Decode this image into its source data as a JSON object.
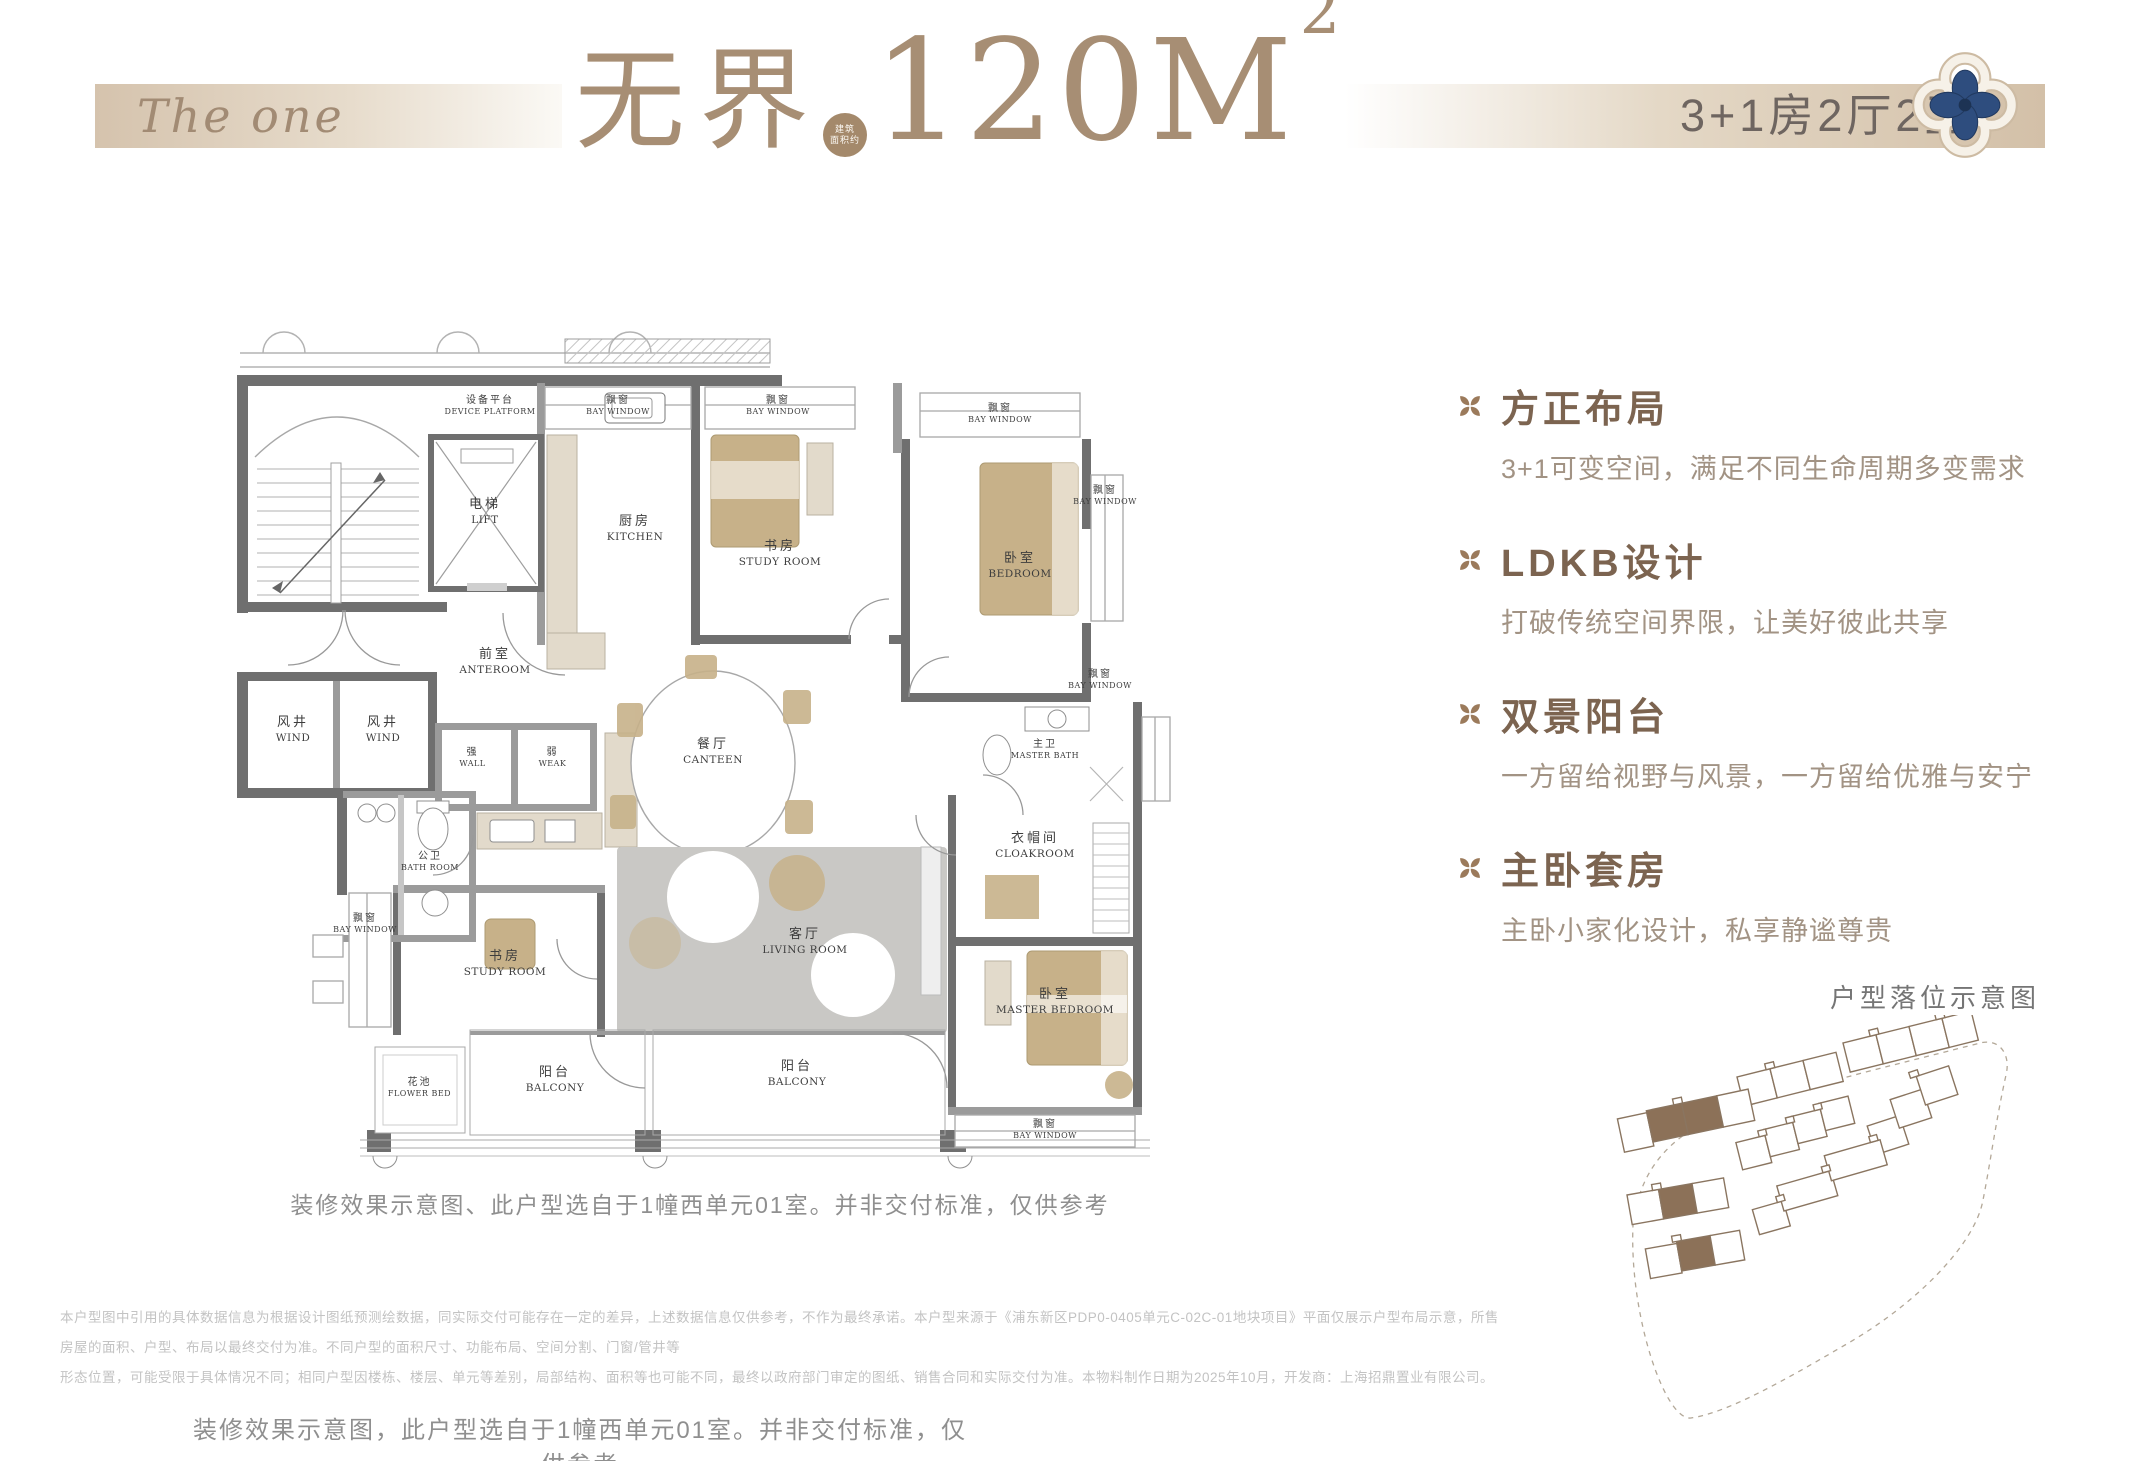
{
  "header": {
    "logo": "The one",
    "title_cn": "无界",
    "area_badge_line1": "建筑",
    "area_badge_line2": "面积约",
    "area_value": "120M",
    "area_sup": "2",
    "spec": "3+1房2厅2卫"
  },
  "floor_plan": {
    "rooms": {
      "device_platform": {
        "cn": "设备平台",
        "en": "DEVICE PLATFORM"
      },
      "lift": {
        "cn": "电梯",
        "en": "LIFT"
      },
      "kitchen": {
        "cn": "厨房",
        "en": "KITCHEN"
      },
      "study": {
        "cn": "书房",
        "en": "STUDY ROOM"
      },
      "bedroom": {
        "cn": "卧室",
        "en": "BEDROOM"
      },
      "wind": {
        "cn": "风井",
        "en": "WIND"
      },
      "anteroom": {
        "cn": "前室",
        "en": "ANTEROOM"
      },
      "strong": {
        "cn": "强",
        "en": "WALL"
      },
      "weak": {
        "cn": "弱",
        "en": "WEAK"
      },
      "canteen": {
        "cn": "餐厅",
        "en": "CANTEEN"
      },
      "bath": {
        "cn": "公卫",
        "en": "BATH ROOM"
      },
      "master_bath": {
        "cn": "主卫",
        "en": "MASTER BATH"
      },
      "cloakroom": {
        "cn": "衣帽间",
        "en": "CLOAKROOM"
      },
      "living": {
        "cn": "客厅",
        "en": "LIVING ROOM"
      },
      "flower_bed": {
        "cn": "花池",
        "en": "FLOWER BED"
      },
      "balcony": {
        "cn": "阳台",
        "en": "BALCONY"
      },
      "master_bedroom": {
        "cn": "卧室",
        "en": "MASTER BEDROOM"
      },
      "bay_window": {
        "cn": "飘窗",
        "en": "BAY WINDOW"
      }
    },
    "caption": "装修效果示意图、此户型选自于1幢西单元01室。并非交付标准，仅供参考"
  },
  "features": [
    {
      "title": "方正布局",
      "desc": "3+1可变空间，满足不同生命周期多变需求"
    },
    {
      "title": "LDKB设计",
      "desc": "打破传统空间界限，让美好彼此共享"
    },
    {
      "title": "双景阳台",
      "desc": "一方留给视野与风景，一方留给优雅与安宁"
    },
    {
      "title": "主卧套房",
      "desc": "主卧小家化设计，私享静谧尊贵"
    }
  ],
  "site_plan": {
    "label": "户型落位示意图"
  },
  "footer": {
    "disclaimer_line1": "本户型图中引用的具体数据信息为根据设计图纸预测绘数据，同实际交付可能存在一定的差异，上述数据信息仅供参考，不作为最终承诺。本户型来源于《浦东新区PDP0-0405单元C-02C-01地块项目》平面仅展示户型布局示意，所售房屋的面积、户型、布局以最终交付为准。不同户型的面积尺寸、功能布局、空间分割、门窗/管井等",
    "disclaimer_line2": "形态位置，可能受限于具体情况不同；相同户型因楼栋、楼层、单元等差别，局部结构、面积等也可能不同，最终以政府部门审定的图纸、销售合同和实际交付为准。本物料制作日期为2025年10月，开发商：上海招鼎置业有限公司。",
    "caption": "装修效果示意图，此户型选自于1幢西单元01室。并非交付标准，仅供参考"
  }
}
